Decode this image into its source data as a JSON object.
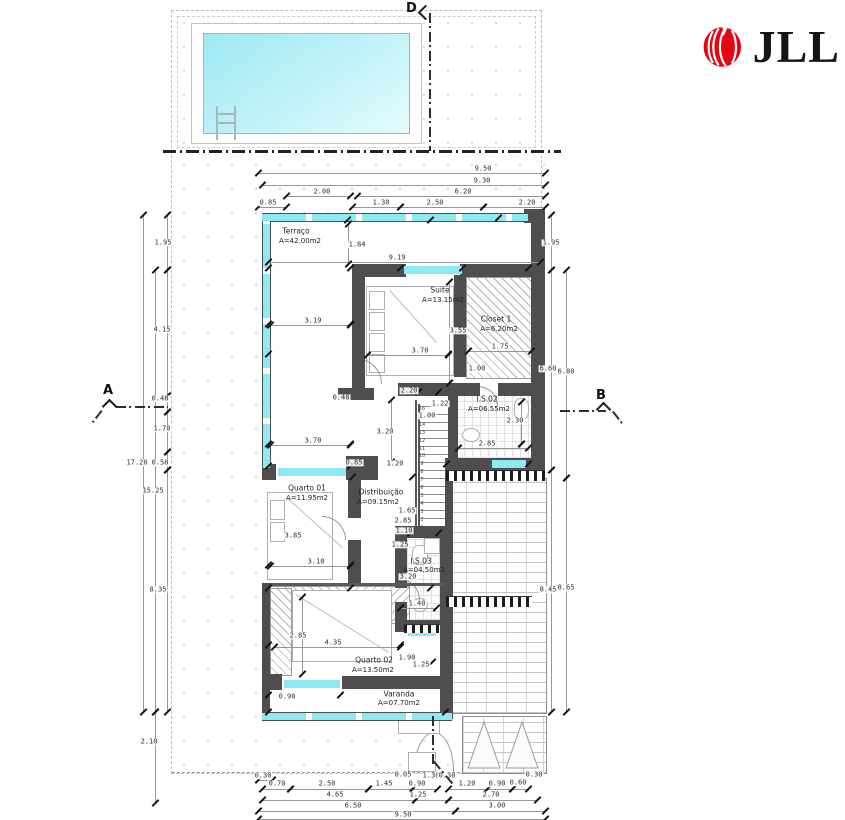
{
  "brand": {
    "text": "JLL",
    "logo_color": "#e30613"
  },
  "sections": [
    {
      "label": "D"
    },
    {
      "label": "A"
    },
    {
      "label": "B"
    }
  ],
  "rooms": [
    {
      "name": "Terraço",
      "area": "A=42.00m2",
      "nx": 296,
      "ny": 231,
      "ax": 300,
      "ay": 241
    },
    {
      "name": "Suite",
      "area": "A=13.15m2",
      "nx": 440,
      "ny": 290,
      "ax": 443,
      "ay": 300
    },
    {
      "name": "Closet 1",
      "area": "A=6.20m2",
      "nx": 496,
      "ny": 319,
      "ax": 499,
      "ay": 329
    },
    {
      "name": "I.S.02",
      "area": "A=06.55m2",
      "nx": 487,
      "ny": 399,
      "ax": 489,
      "ay": 409
    },
    {
      "name": "Quarto 01",
      "area": "A=11.95m2",
      "nx": 307,
      "ny": 488,
      "ax": 307,
      "ay": 498
    },
    {
      "name": "Distribuição",
      "area": "A=09.15m2",
      "nx": 381,
      "ny": 492,
      "ax": 378,
      "ay": 502
    },
    {
      "name": "I.S.03",
      "area": "A=04.50m2",
      "nx": 421,
      "ny": 561,
      "ax": 424,
      "ay": 570
    },
    {
      "name": "Quarto 02",
      "area": "A=13.50m2",
      "nx": 374,
      "ny": 660,
      "ax": 373,
      "ay": 670
    },
    {
      "name": "Varanda",
      "area": "A=07.70m2",
      "nx": 399,
      "ny": 694,
      "ax": 399,
      "ay": 703
    }
  ],
  "stairs": {
    "steps": [
      16,
      15,
      14,
      13,
      12,
      11,
      10,
      9,
      8,
      7,
      6,
      5,
      4,
      3,
      2,
      1
    ]
  },
  "dims": {
    "top": [
      {
        "v": "9.50",
        "x": 483,
        "y": 169,
        "line": [
          258,
          173,
          545,
          173
        ]
      },
      {
        "v": "9.30",
        "x": 482,
        "y": 181,
        "line": [
          262,
          185,
          545,
          185
        ]
      },
      {
        "v": "2.00",
        "x": 322,
        "y": 192,
        "line": [
          286,
          196,
          350,
          196
        ]
      },
      {
        "v": "6.20",
        "x": 463,
        "y": 192,
        "line": [
          357,
          196,
          545,
          196
        ]
      },
      {
        "v": "0.85",
        "x": 268,
        "y": 203,
        "line": [
          258,
          207,
          286,
          207
        ]
      },
      {
        "v": "1.30",
        "x": 381,
        "y": 203,
        "line": [
          352,
          207,
          400,
          207
        ]
      },
      {
        "v": "2.50",
        "x": 435,
        "y": 203,
        "line": [
          400,
          207,
          483,
          207
        ]
      },
      {
        "v": "2.20",
        "x": 527,
        "y": 203,
        "line": [
          483,
          207,
          545,
          207
        ]
      }
    ],
    "left": [
      {
        "v": "17.20",
        "x": 137,
        "y": 463,
        "line": [
          143,
          215,
          143,
          712
        ]
      },
      {
        "v": "15.25",
        "x": 153,
        "y": 491,
        "line": [
          155,
          270,
          155,
          712
        ]
      },
      {
        "v": "1.95",
        "x": 163,
        "y": 243,
        "line": [
          167,
          215,
          167,
          270
        ]
      },
      {
        "v": "4.15",
        "x": 162,
        "y": 330,
        "line": [
          167,
          270,
          167,
          396
        ]
      },
      {
        "v": "0.48",
        "x": 160,
        "y": 399,
        "line": [
          167,
          396,
          167,
          412
        ]
      },
      {
        "v": "1.70",
        "x": 162,
        "y": 429,
        "line": [
          167,
          412,
          167,
          452
        ]
      },
      {
        "v": "0.58",
        "x": 160,
        "y": 463,
        "line": [
          167,
          452,
          167,
          470
        ]
      },
      {
        "v": "8.35",
        "x": 158,
        "y": 590,
        "line": [
          167,
          470,
          167,
          712
        ]
      },
      {
        "v": "2.10",
        "x": 149,
        "y": 742,
        "line": [
          155,
          712,
          155,
          803
        ]
      }
    ],
    "right": [
      {
        "v": "1.95",
        "x": 551,
        "y": 243,
        "line": [
          551,
          215,
          551,
          270
        ]
      },
      {
        "v": "6.60",
        "x": 548,
        "y": 369,
        "line": [
          551,
          270,
          551,
          470
        ]
      },
      {
        "v": "8.45",
        "x": 548,
        "y": 590,
        "line": [
          551,
          470,
          551,
          712
        ]
      },
      {
        "v": "6.80",
        "x": 566,
        "y": 372,
        "line": [
          566,
          270,
          566,
          478
        ]
      },
      {
        "v": "8.65",
        "x": 566,
        "y": 588,
        "line": [
          566,
          478,
          566,
          712
        ]
      }
    ],
    "bottom": [
      {
        "v": "0.30",
        "x": 263,
        "y": 776,
        "line": [
          258,
          780,
          272,
          780
        ]
      },
      {
        "v": "0.05",
        "x": 403,
        "y": 775
      },
      {
        "v": "1.30",
        "x": 431,
        "y": 776
      },
      {
        "v": "0.30",
        "x": 447,
        "y": 776
      },
      {
        "v": "0.30",
        "x": 534,
        "y": 775
      },
      {
        "v": "0.70",
        "x": 277,
        "y": 784,
        "line": [
          262,
          789,
          290,
          789
        ]
      },
      {
        "v": "2.50",
        "x": 327,
        "y": 784,
        "line": [
          290,
          789,
          368,
          789
        ]
      },
      {
        "v": "1.45",
        "x": 384,
        "y": 784,
        "line": [
          368,
          789,
          412,
          789
        ]
      },
      {
        "v": "0.90",
        "x": 417,
        "y": 784,
        "line": [
          412,
          789,
          437,
          789
        ]
      },
      {
        "v": "1.20",
        "x": 467,
        "y": 784,
        "line": [
          448,
          789,
          487,
          789
        ]
      },
      {
        "v": "0.90",
        "x": 497,
        "y": 784,
        "line": [
          487,
          789,
          512,
          789
        ]
      },
      {
        "v": "0.60",
        "x": 518,
        "y": 783,
        "line": [
          512,
          789,
          528,
          789
        ]
      },
      {
        "v": "4.65",
        "x": 335,
        "y": 795,
        "line": [
          262,
          800,
          415,
          800
        ]
      },
      {
        "v": "1.25",
        "x": 418,
        "y": 795,
        "line": [
          415,
          800,
          448,
          800
        ]
      },
      {
        "v": "2.70",
        "x": 491,
        "y": 795,
        "line": [
          448,
          800,
          537,
          800
        ]
      },
      {
        "v": "6.50",
        "x": 353,
        "y": 806,
        "line": [
          258,
          811,
          455,
          811
        ]
      },
      {
        "v": "3.00",
        "x": 497,
        "y": 806,
        "line": [
          455,
          811,
          545,
          811
        ]
      },
      {
        "v": "9.50",
        "x": 403,
        "y": 815,
        "line": [
          258,
          819,
          545,
          819
        ]
      }
    ],
    "inner": [
      {
        "v": "1.84",
        "x": 357,
        "y": 245,
        "line": [
          348,
          224,
          348,
          264
        ]
      },
      {
        "v": "9.19",
        "x": 397,
        "y": 258,
        "line": [
          268,
          262,
          540,
          262
        ]
      },
      {
        "v": "3.19",
        "x": 313,
        "y": 321,
        "line": [
          270,
          325,
          350,
          325
        ]
      },
      {
        "v": "3.55",
        "x": 458,
        "y": 331,
        "line": [
          449,
          282,
          449,
          383
        ]
      },
      {
        "v": "3.70",
        "x": 420,
        "y": 351,
        "line": [
          367,
          355,
          448,
          355
        ]
      },
      {
        "v": "1.75",
        "x": 500,
        "y": 347,
        "line": [
          468,
          351,
          531,
          351
        ]
      },
      {
        "v": "1.00",
        "x": 477,
        "y": 369
      },
      {
        "v": "2.20",
        "x": 409,
        "y": 391
      },
      {
        "v": "0.48",
        "x": 341,
        "y": 398
      },
      {
        "v": "1.22",
        "x": 440,
        "y": 404
      },
      {
        "v": "1.00",
        "x": 427,
        "y": 416
      },
      {
        "v": "3.20",
        "x": 385,
        "y": 432,
        "line": [
          391,
          400,
          391,
          462
        ]
      },
      {
        "v": "2.30",
        "x": 515,
        "y": 421,
        "line": [
          521,
          402,
          521,
          444
        ]
      },
      {
        "v": "2.85",
        "x": 487,
        "y": 444,
        "line": [
          458,
          448,
          528,
          448
        ]
      },
      {
        "v": "3.70",
        "x": 313,
        "y": 441,
        "line": [
          270,
          445,
          350,
          445
        ]
      },
      {
        "v": "0.85",
        "x": 354,
        "y": 463
      },
      {
        "v": "1.20",
        "x": 395,
        "y": 464
      },
      {
        "v": "1.65",
        "x": 407,
        "y": 511
      },
      {
        "v": "2.85",
        "x": 403,
        "y": 521
      },
      {
        "v": "1.10",
        "x": 404,
        "y": 531
      },
      {
        "v": "1.25",
        "x": 400,
        "y": 545
      },
      {
        "v": "3.85",
        "x": 293,
        "y": 536
      },
      {
        "v": "3.10",
        "x": 316,
        "y": 562,
        "line": [
          270,
          566,
          350,
          566
        ]
      },
      {
        "v": "3.20",
        "x": 408,
        "y": 577
      },
      {
        "v": "1.40",
        "x": 417,
        "y": 604,
        "line": [
          400,
          608,
          436,
          608
        ]
      },
      {
        "v": "2.85",
        "x": 298,
        "y": 636,
        "line": [
          302,
          597,
          302,
          674
        ]
      },
      {
        "v": "4.35",
        "x": 333,
        "y": 643,
        "line": [
          274,
          647,
          400,
          647
        ]
      },
      {
        "v": "1.90",
        "x": 407,
        "y": 658
      },
      {
        "v": "1.25",
        "x": 421,
        "y": 665
      },
      {
        "v": "0.90",
        "x": 287,
        "y": 697
      }
    ]
  },
  "ticks": [
    [
      347,
      220
    ],
    [
      430,
      220
    ],
    [
      498,
      218
    ],
    [
      268,
      268
    ],
    [
      350,
      268
    ],
    [
      400,
      268
    ],
    [
      462,
      268
    ],
    [
      528,
      268
    ],
    [
      268,
      324
    ],
    [
      350,
      324
    ],
    [
      268,
      354
    ],
    [
      448,
      354
    ],
    [
      268,
      444
    ],
    [
      350,
      444
    ],
    [
      418,
      392
    ],
    [
      438,
      392
    ],
    [
      268,
      466
    ],
    [
      350,
      466
    ],
    [
      446,
      464
    ],
    [
      528,
      464
    ],
    [
      268,
      565
    ],
    [
      350,
      565
    ],
    [
      268,
      588
    ],
    [
      350,
      588
    ],
    [
      430,
      588
    ],
    [
      400,
      645
    ],
    [
      268,
      645
    ],
    [
      268,
      695
    ],
    [
      340,
      695
    ],
    [
      432,
      662
    ],
    [
      445,
      712
    ],
    [
      268,
      712
    ],
    [
      410,
      533
    ],
    [
      438,
      533
    ],
    [
      352,
      477
    ],
    [
      412,
      477
    ],
    [
      521,
      444
    ],
    [
      449,
      383
    ]
  ]
}
